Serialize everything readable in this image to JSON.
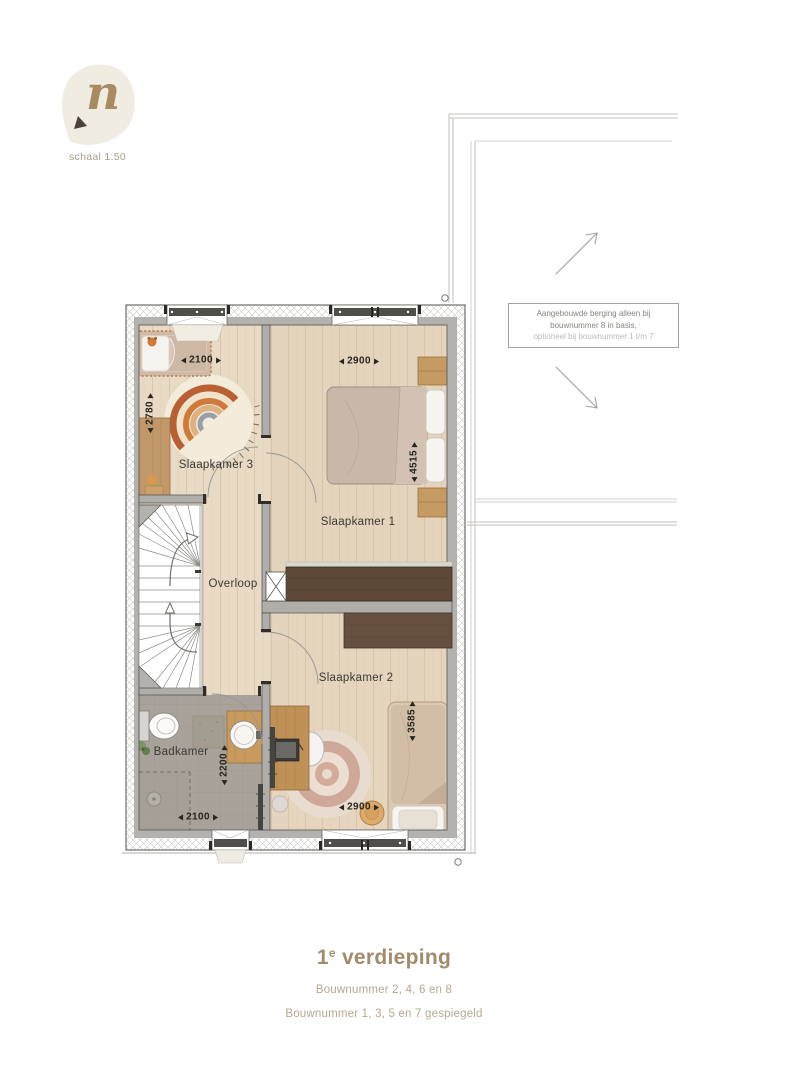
{
  "logo": {
    "letter": "n",
    "scale_label": "schaal 1:50"
  },
  "plan": {
    "room_labels": {
      "slaapkamer3": "Slaapkamer 3",
      "slaapkamer1": "Slaapkamer 1",
      "overloop": "Overloop",
      "slaapkamer2": "Slaapkamer 2",
      "badkamer": "Badkamer"
    },
    "dimensions": {
      "s3_width": "2100",
      "s3_depth": "2780",
      "s1_width": "2900",
      "s1_depth": "4515",
      "bad_depth": "2200",
      "bad_width": "2100",
      "s2_width": "2900",
      "s2_depth": "3585"
    },
    "note": {
      "line1": "Aangebouwde berging alleen bij",
      "line2": "bouwnummer 8 in basis,",
      "line3": "optioneel bij bouwnummer 1 t/m 7"
    }
  },
  "footer": {
    "title_num": "1",
    "title_sup": "e",
    "title_rest": " verdieping",
    "subtitle1": "Bouwnummer 2, 4, 6 en 8",
    "subtitle2": "Bouwnummer 1, 3, 5 en 7 gespiegeld"
  },
  "colors": {
    "wood_floor": "#e8dac4",
    "bathroom_floor": "#a6a199",
    "wall_gray": "#b4b2ae",
    "wardrobe_dark": "#5d4936",
    "rug_terracotta": "#b95f31",
    "accent_brown": "#a28b6a",
    "subtitle_brown": "#b5a88f",
    "label_dark": "#3b3a37"
  }
}
